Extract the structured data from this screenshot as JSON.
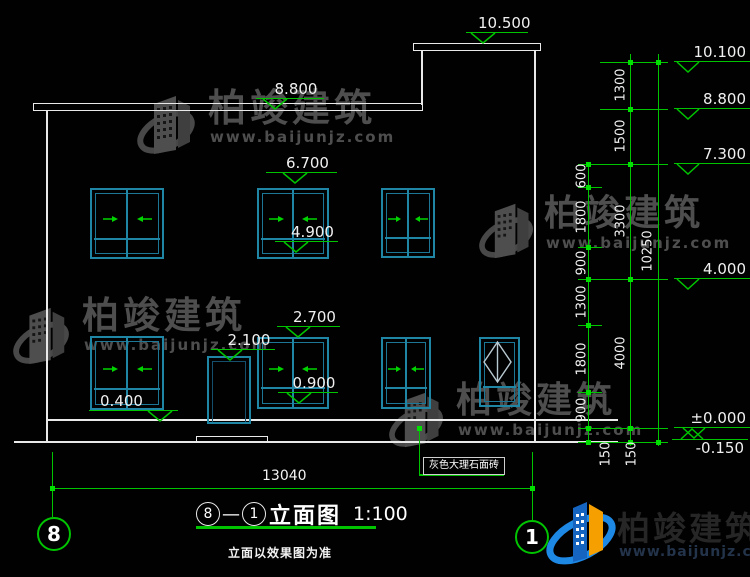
{
  "watermark": {
    "brand": "柏竣建筑",
    "url": "www.baijunjz.com"
  },
  "title": {
    "bubble_left": "8",
    "separator": "—",
    "bubble_right": "1",
    "name": "立面图",
    "scale": "1:100",
    "note": "立面以效果图为准"
  },
  "axis_bubbles": {
    "left": "8",
    "right": "1"
  },
  "material_note": "灰色大理石面砖",
  "levels_left": [
    "10.500",
    "8.800",
    "6.700",
    "4.900",
    "2.700",
    "2.100",
    "0.900",
    "0.400"
  ],
  "levels_right": [
    "10.100",
    "8.800",
    "7.300",
    "4.000",
    "±0.000",
    "-0.150"
  ],
  "dims": {
    "bottom": "13040",
    "overall": "10250",
    "inner_chain": [
      "600",
      "1800",
      "900",
      "1300",
      "1800",
      "900",
      "150"
    ],
    "outer_chain": [
      "1300",
      "1500",
      "3300",
      "4000",
      "150"
    ]
  },
  "colors": {
    "background": "#000000",
    "outline_white": "#e9e9e9",
    "dimension_green": "#00c400",
    "window_teal": "#1f87a5"
  }
}
